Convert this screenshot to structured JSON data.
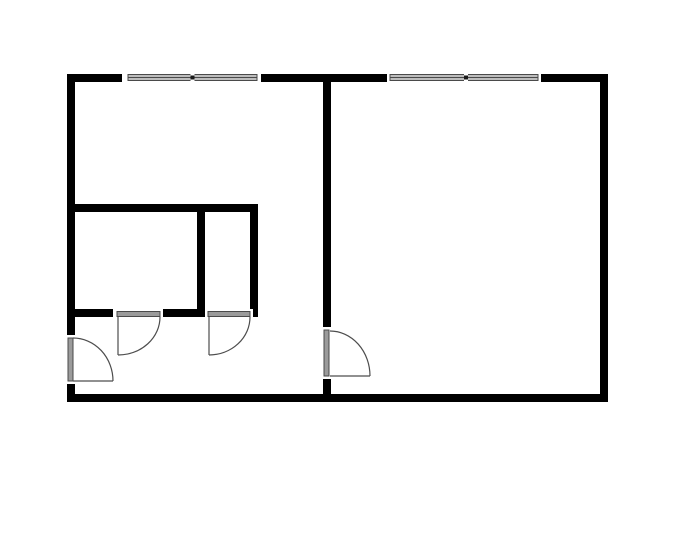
{
  "canvas": {
    "width": 700,
    "height": 550,
    "background": "#ffffff"
  },
  "palette": {
    "wall": "#000000",
    "opening": "#ffffff",
    "frame": "#4a4a4a",
    "glass": "#bdbdbd",
    "panel": "#9b9b9b",
    "mullion": "#1a1a1a",
    "swing": "#4d4d4d"
  },
  "walls": [
    {
      "name": "outer-wall-top",
      "x": 67,
      "y": 74,
      "w": 541,
      "h": 8
    },
    {
      "name": "outer-wall-left",
      "x": 67,
      "y": 74,
      "w": 8,
      "h": 328
    },
    {
      "name": "outer-wall-right",
      "x": 600,
      "y": 74,
      "w": 8,
      "h": 328
    },
    {
      "name": "outer-wall-bottom",
      "x": 67,
      "y": 394,
      "w": 541,
      "h": 8
    },
    {
      "name": "divider-wall-vertical",
      "x": 323,
      "y": 82,
      "w": 8,
      "h": 312
    },
    {
      "name": "interior-wall-upper-horizontal",
      "x": 67,
      "y": 204,
      "w": 191,
      "h": 8
    },
    {
      "name": "interior-wall-middle-vertical",
      "x": 197,
      "y": 212,
      "w": 8,
      "h": 105
    },
    {
      "name": "interior-wall-right-vertical",
      "x": 250,
      "y": 204,
      "w": 8,
      "h": 113
    },
    {
      "name": "interior-wall-lower-left-segment",
      "x": 67,
      "y": 309,
      "w": 46,
      "h": 8
    },
    {
      "name": "interior-wall-lower-right-segment",
      "x": 163,
      "y": 309,
      "w": 42,
      "h": 8
    }
  ],
  "openings": [
    {
      "name": "window-1-opening",
      "x": 122,
      "y": 74,
      "w": 139,
      "h": 8
    },
    {
      "name": "window-2-opening",
      "x": 387,
      "y": 74,
      "w": 154,
      "h": 8
    },
    {
      "name": "entry-door-opening",
      "x": 67,
      "y": 335,
      "w": 8,
      "h": 49
    },
    {
      "name": "divider-door-opening",
      "x": 323,
      "y": 327,
      "w": 8,
      "h": 52
    },
    {
      "name": "left-room-door-opening",
      "x": 113,
      "y": 309,
      "w": 50,
      "h": 8
    },
    {
      "name": "right-room-door-opening",
      "x": 205,
      "y": 309,
      "w": 48,
      "h": 8
    }
  ],
  "windows": [
    {
      "name": "window-1",
      "x": 128,
      "y": 74.5,
      "w": 129,
      "h": 6,
      "mullion_x": 192.5
    },
    {
      "name": "window-2",
      "x": 390,
      "y": 74.5,
      "w": 148,
      "h": 6,
      "mullion_x": 466
    }
  ],
  "door_panels": [
    {
      "name": "entry-door-panel",
      "x": 68,
      "y": 338,
      "w": 5,
      "h": 43
    },
    {
      "name": "divider-door-panel",
      "x": 324,
      "y": 330,
      "w": 5,
      "h": 46
    },
    {
      "name": "left-room-door-panel",
      "x": 117,
      "y": 311.5,
      "w": 43,
      "h": 5
    },
    {
      "name": "right-room-door-panel",
      "x": 208,
      "y": 311.5,
      "w": 42,
      "h": 5
    }
  ],
  "door_swings": [
    {
      "name": "entry-door-swing",
      "leaf": "M 73 381 L 113 381",
      "arc": "M 113 381 A 40 43 0 0 0 73 338"
    },
    {
      "name": "left-room-door-swing",
      "leaf": "M 118 317 L 118 355",
      "arc": "M 118 355 A 42 38 0 0 0 160 317"
    },
    {
      "name": "right-room-door-swing",
      "leaf": "M 209 317 L 209 355",
      "arc": "M 209 355 A 41 38 0 0 0 250 317"
    },
    {
      "name": "divider-door-swing",
      "leaf": "M 330 376 L 370 376",
      "arc": "M 370 376 A 40 45 0 0 0 330 331"
    }
  ]
}
